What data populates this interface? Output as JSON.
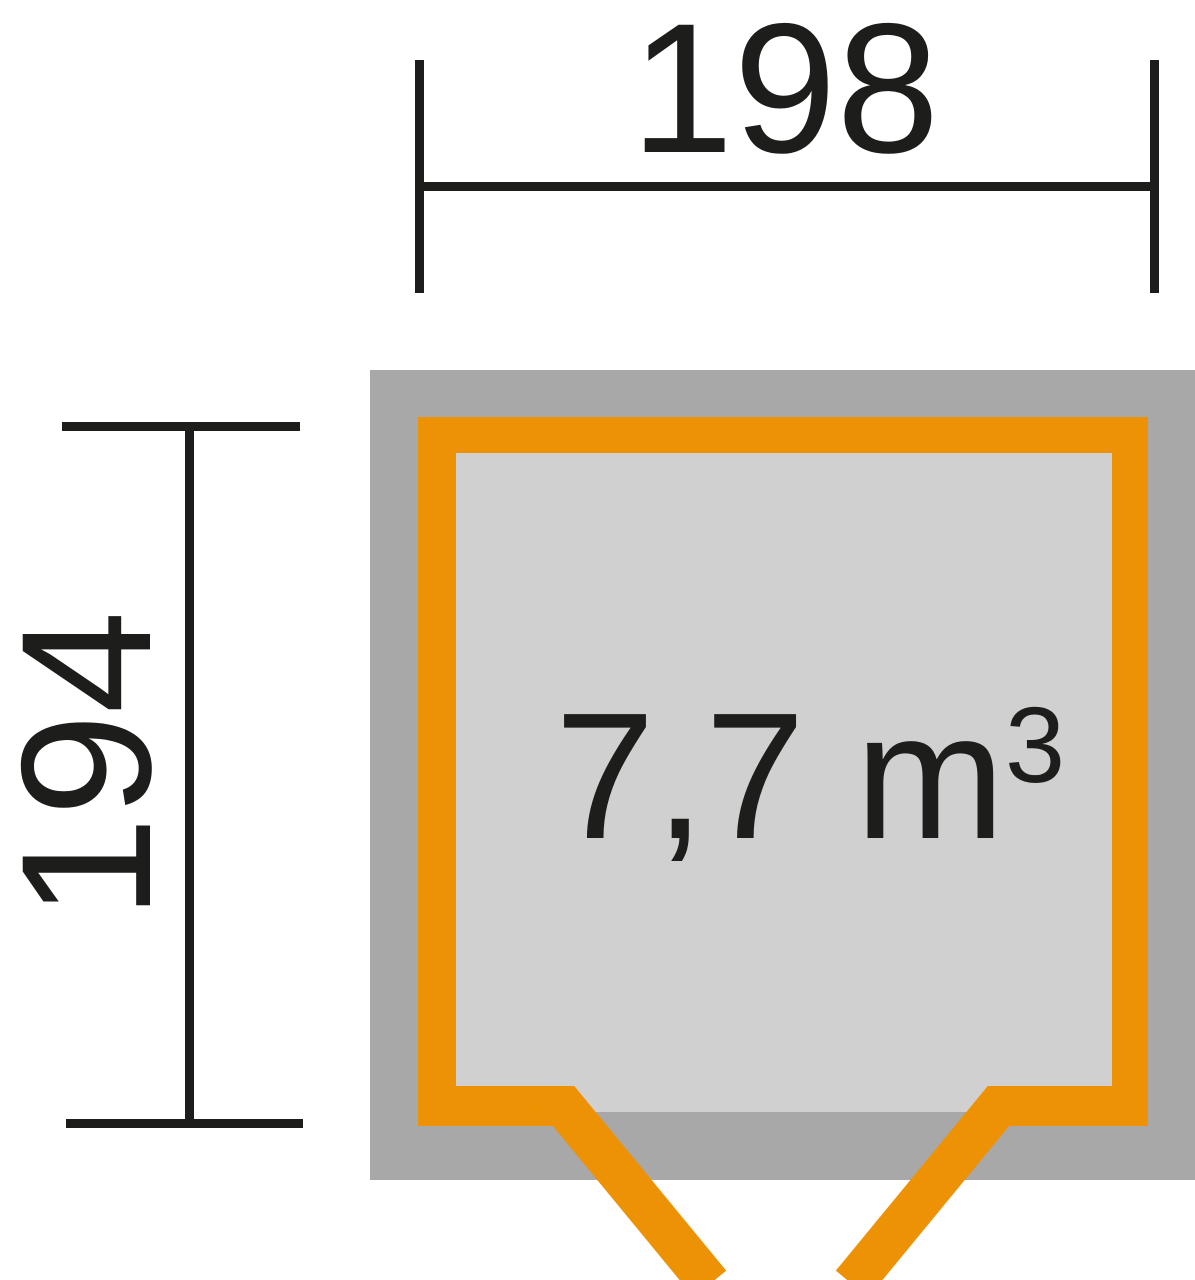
{
  "figure": {
    "type": "floor-plan-dimension-diagram",
    "width_dimension": {
      "label": "198"
    },
    "depth_dimension": {
      "label": "194"
    },
    "volume": {
      "main": "7,7 m",
      "superscript": "3"
    },
    "colors": {
      "background": "#ffffff",
      "wall_outer_gray": "#a8a8a8",
      "floor_light_gray": "#d0d0d1",
      "frame_orange": "#ee9205",
      "ink": "#1d1d1b"
    }
  }
}
